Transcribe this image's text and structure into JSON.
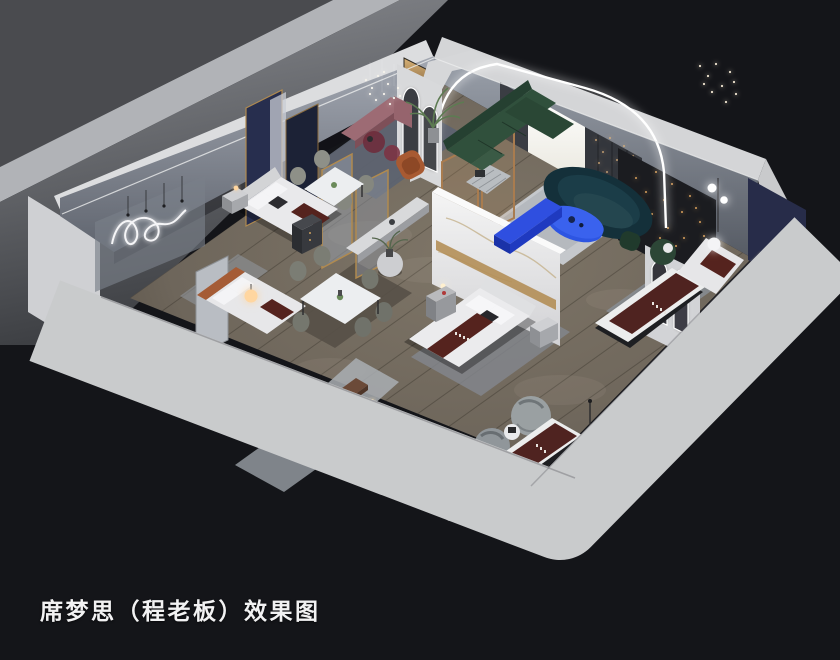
{
  "caption": {
    "text": "席梦思（程老板）效果图"
  },
  "scene": {
    "type": "isometric-interior-cutaway-render",
    "subject": "mattress-showroom-floorplan",
    "areas": [
      "bedroom-display-left",
      "bedroom-display-front-left",
      "bedroom-display-center",
      "dining-display-upper",
      "dining-display-center",
      "living-lounge",
      "mattress-gallery-right",
      "led-arch-passage"
    ],
    "palette": {
      "backdrop_dark": "#141519",
      "backdrop_gray": "#4a4b4f",
      "backdrop_band": "#b1b3b7",
      "outer_wall": "#c6c8ca",
      "wall_top": "#dcdddf",
      "inner_wall": "#9aa0ac",
      "floor_wood": "#6e665b",
      "marble": "#efefef",
      "gold_trim": "#b08a4f",
      "navy_panel": "#272e4e",
      "green_sofa": "#30503c",
      "teal_sofa": "#14303a",
      "accent_blue": "#2d55e2",
      "mauve_bench": "#9d6b74",
      "rust_chair": "#a85a32",
      "mattress_runner": "#55231e",
      "bedding_white": "#e9e9eb",
      "led_white": "#ffffff",
      "lamp_warm": "#ffd6a0"
    }
  }
}
